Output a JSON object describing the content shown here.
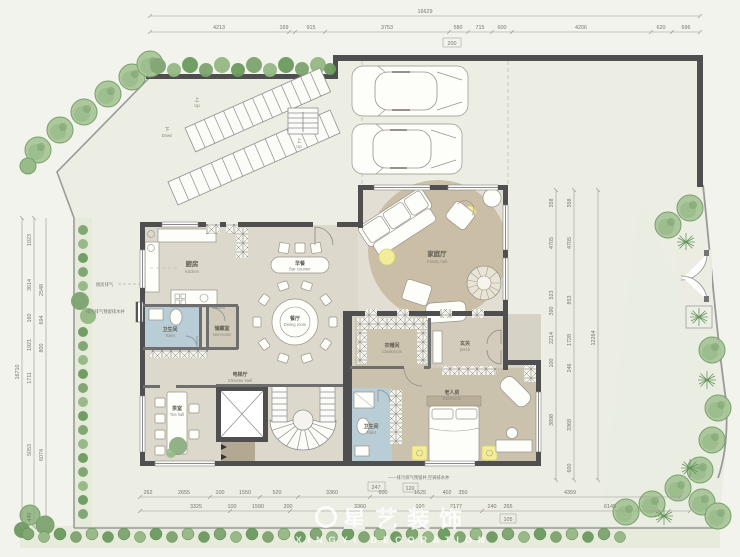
{
  "watermark": {
    "cn": "星艺装饰",
    "en": "XINGYI DECORATION"
  },
  "colors": {
    "wall": "#4f4f4f",
    "bath": "#b9cdd6",
    "rug": "#c8bba1",
    "accent": "#f3ec9a",
    "plant": "#7da46f",
    "floor": "#dcd8cc"
  },
  "labels": {
    "kitchen_cn": "厨房",
    "kitchen_en": "Kitchen",
    "bar_cn": "早餐",
    "bar_en": "Bar counter",
    "dining_cn": "餐厅",
    "dining_en": "Dining room",
    "family_cn": "家庭厅",
    "family_en": "Family hall",
    "toilet1_cn": "卫生间",
    "toilet1_en": "Toilet",
    "store_cn": "储藏室",
    "store_en": "storeroom",
    "elev_cn": "电梯厅",
    "elev_en": "Elevator Hall",
    "tea_cn": "茶室",
    "tea_en": "Tea hall",
    "cloak_cn": "衣帽间",
    "cloak_en": "Cloakroom",
    "porch_cn": "玄关",
    "porch_en": "porch",
    "bed_cn": "老人房",
    "bed_en": "Eld.Room",
    "toilet2_cn": "卫生间",
    "toilet2_en": "Toilet"
  },
  "stairs": {
    "down_cn": "下",
    "down_en": "Down",
    "up_cn": "上",
    "up_en": "Up"
  },
  "notes": {
    "kitchen_vent": "厨房排气",
    "left_well": "排污排气预留排水井",
    "bottom_well": "——排污排气预留井,空调排水井"
  },
  "dims": {
    "top_total": "16629",
    "top": [
      "4213",
      "169",
      "915",
      "3753",
      "580",
      "715",
      "600",
      "4206",
      "620",
      "696"
    ],
    "top_sub": "200",
    "left_total": "16710",
    "left_a": [
      "1023",
      "3614",
      "160",
      "1921",
      "1711",
      "5053",
      "440"
    ],
    "left_b": [
      "2548",
      "694",
      "800",
      "6074"
    ],
    "right_total": "12264",
    "right_a": [
      "358",
      "4705",
      "523",
      "390",
      "2214",
      "100",
      "3898"
    ],
    "right_b": [
      "358",
      "4705",
      "853",
      "1728",
      "246",
      "3368",
      "600"
    ],
    "bottom_a": [
      "262",
      "2655",
      "100",
      "1550",
      "520",
      "3360",
      "600",
      "1625",
      "402",
      "350",
      "4359"
    ],
    "bottom_b": [
      "3325",
      "100",
      "1590",
      "200",
      "3360",
      "100",
      "2177",
      "240",
      "265",
      "6145"
    ],
    "boxed": [
      "247",
      "120",
      "105"
    ]
  }
}
